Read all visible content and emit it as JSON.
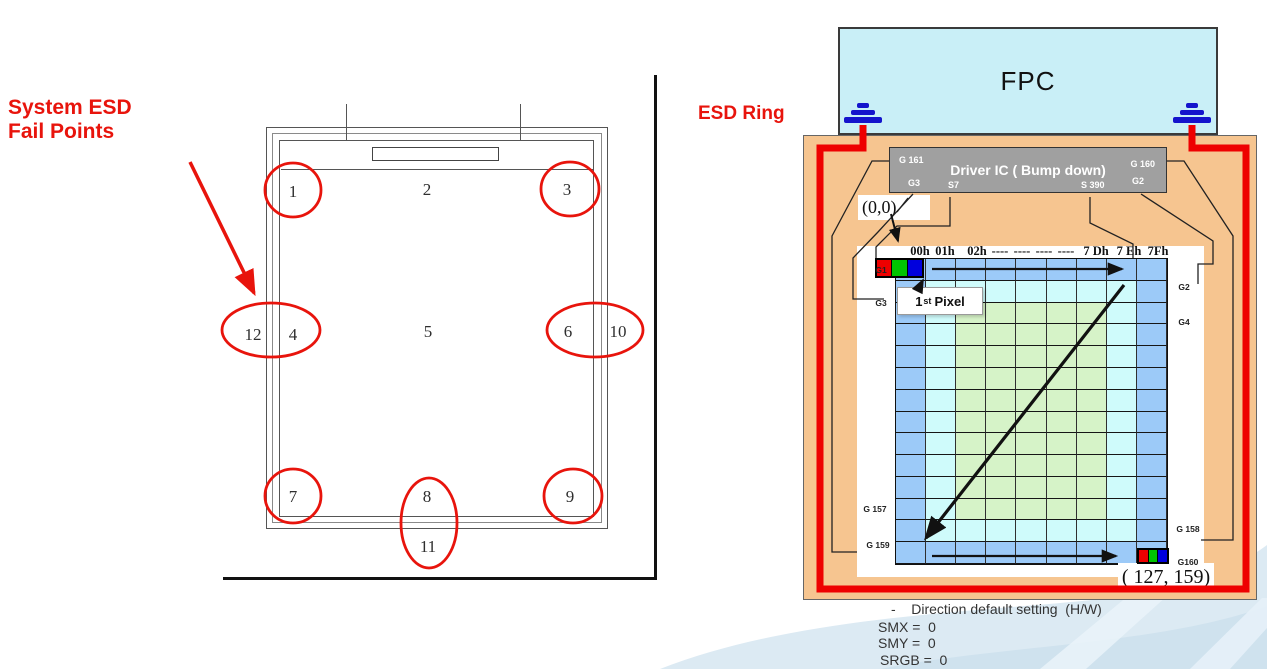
{
  "left": {
    "title_line1": "System ESD",
    "title_line2": "Fail Points",
    "fail_point_labels": [
      "1",
      "2",
      "3",
      "4",
      "5",
      "6",
      "7",
      "8",
      "9",
      "10",
      "11",
      "12"
    ]
  },
  "right": {
    "esd_ring_label": "ESD Ring",
    "fpc_label": "FPC",
    "driver_ic": {
      "title": "Driver IC ( Bump down)",
      "pin_top_left": "G 161",
      "pin_top_right": "G 160",
      "pin_g3": "G3",
      "pin_s7": "S7",
      "pin_s390": "S 390",
      "pin_g2": "G2"
    },
    "origin_label": "(0,0)",
    "first_pixel": {
      "num": "1",
      "sup": "st",
      "word": "Pixel"
    },
    "end_coord_label": "( 127, 159)",
    "grid": {
      "cols": 9,
      "rows": 14,
      "column_headers": [
        "00h",
        "01h",
        "02h",
        "----",
        "----",
        "----",
        "----",
        "7 Dh",
        "7 Eh",
        "7Fh"
      ],
      "row_labels_left": [
        "G1",
        "G3",
        "G 157",
        "G 159"
      ],
      "row_labels_right": [
        "G2",
        "G4",
        "G 158",
        "G160"
      ],
      "colors": {
        "outer": "#9CCAF8",
        "mid": "#CFFBFB",
        "inner": "#D6F3C8"
      }
    },
    "notes": [
      "-    Direction default setting  (H/W)",
      "SMX =  0",
      "SMY =  0",
      "SRGB =  0"
    ]
  },
  "colors": {
    "accent_red": "#E8140C",
    "ring_red": "#EE0000",
    "panel_orange": "#F6C590",
    "fpc_cyan": "#C9EFF7",
    "ic_gray": "#A0A0A0",
    "ground_blue": "#1414CC",
    "pixel_red": "#EE0000",
    "pixel_green": "#00C400",
    "pixel_blue": "#0000DD"
  }
}
